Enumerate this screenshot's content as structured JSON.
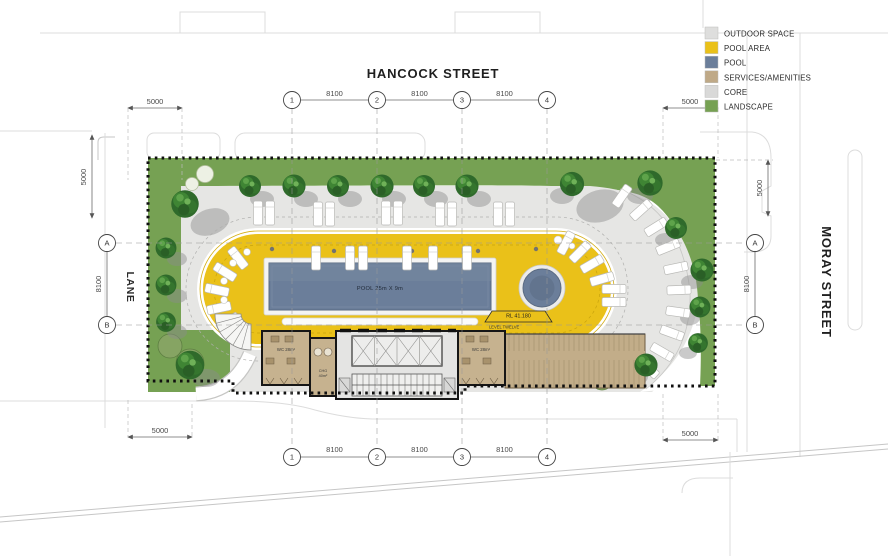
{
  "palette": {
    "outdoor_space": "#dededd",
    "pool_area": "#eac119",
    "pool": "#6b7e9a",
    "services_amenities": "#bfa987",
    "core": "#d9d9d8",
    "landscape": "#76a153"
  },
  "legend": {
    "items": [
      {
        "label": "OUTDOOR SPACE",
        "color": "#dededd"
      },
      {
        "label": "POOL AREA",
        "color": "#eac119"
      },
      {
        "label": "POOL",
        "color": "#6b7e9a"
      },
      {
        "label": "SERVICES/AMENITIES",
        "color": "#bfa987"
      },
      {
        "label": "CORE",
        "color": "#d9d9d8"
      },
      {
        "label": "LANDSCAPE",
        "color": "#76a153"
      }
    ]
  },
  "streets": {
    "top": "HANCOCK STREET",
    "right": "MORAY STREET",
    "left": "LANE"
  },
  "grid": {
    "cols": [
      "1",
      "2",
      "3",
      "4"
    ],
    "rows": [
      "A",
      "B"
    ]
  },
  "dimensions": {
    "bays_top": [
      "8100",
      "8100",
      "8100"
    ],
    "bays_bottom": [
      "8100",
      "8100",
      "8100"
    ],
    "left_rows": "8100",
    "right_rows": "8100",
    "setback_top_left": "5000",
    "setback_left": "5000",
    "setback_top_right": "5000",
    "setback_right": "5000",
    "setback_bottom_left": "5000",
    "setback_bottom_right": "5000"
  },
  "plan": {
    "pool_label": "POOL 25m X 9m",
    "level_marker": {
      "rl": "RL 41.180",
      "level": "LEVEL TWELVE"
    },
    "rooms": {
      "wc_left": "WC 28m²",
      "wc_right": "WC 28m²",
      "chg": "CHG",
      "chg_area": "40m²"
    }
  }
}
